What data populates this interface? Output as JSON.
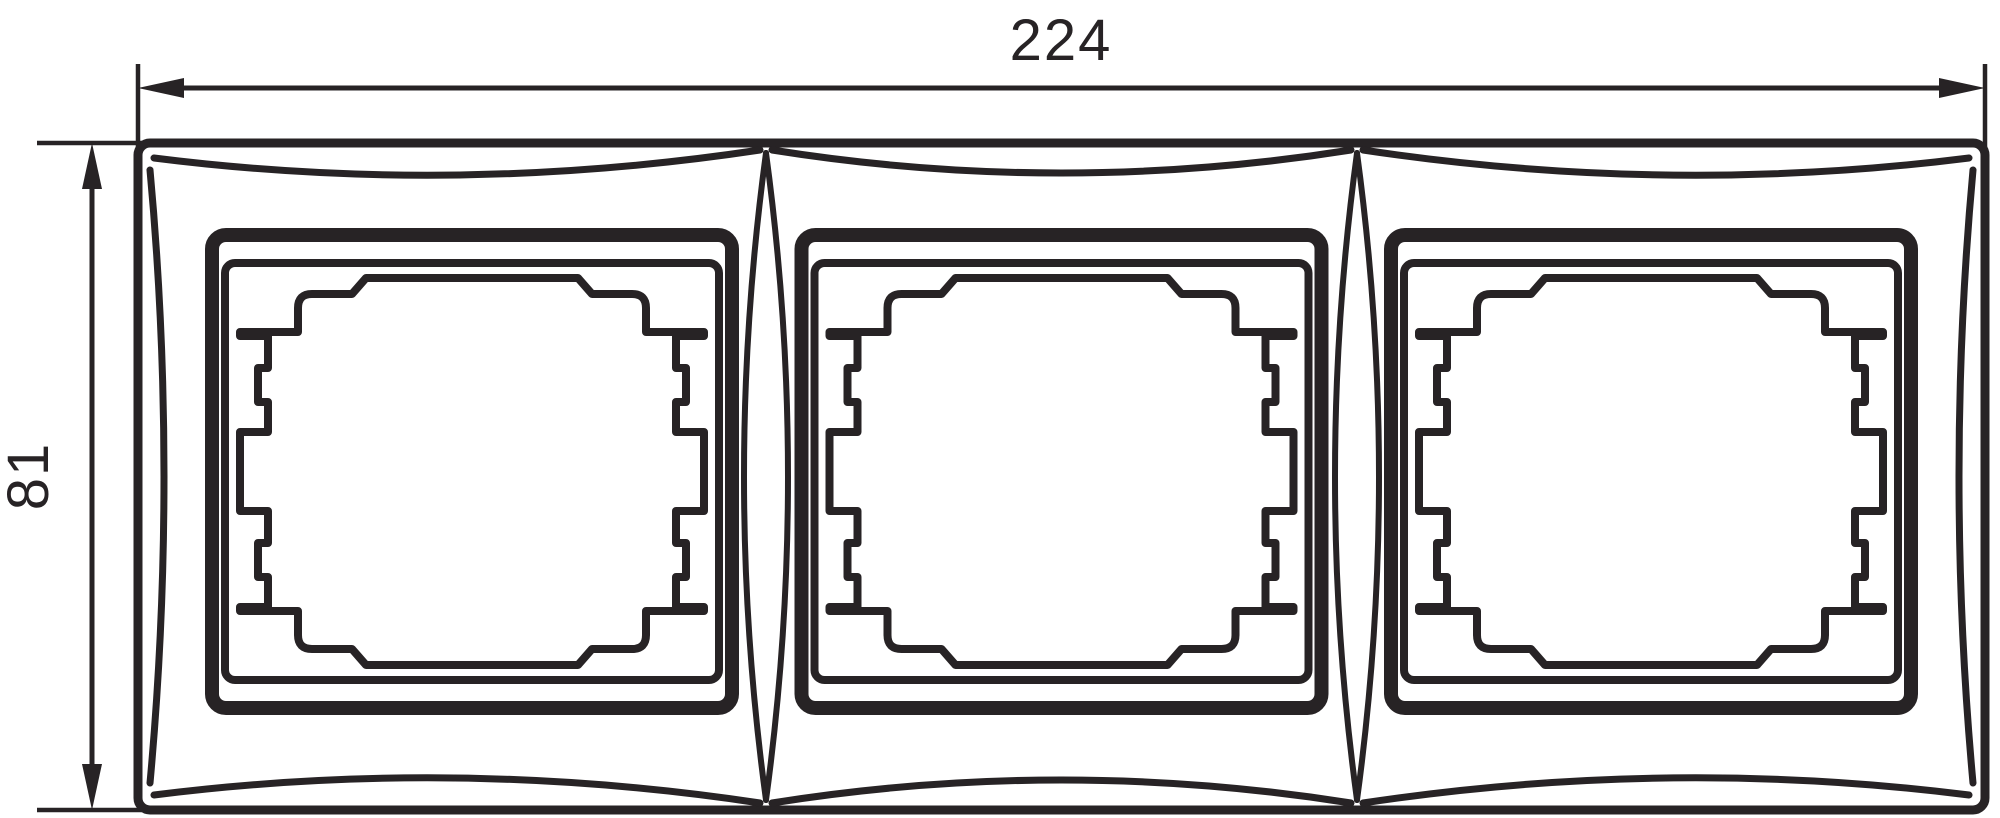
{
  "drawing": {
    "type": "technical-dimension-drawing",
    "modules": 3,
    "dimension_width_label": "224",
    "dimension_height_label": "81",
    "colors": {
      "line": "#272325",
      "background": "#ffffff"
    }
  }
}
